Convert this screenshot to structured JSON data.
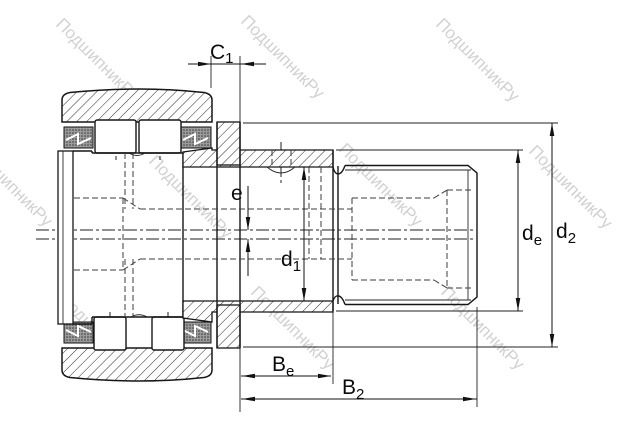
{
  "watermark": {
    "text": "ПодшипникРу"
  },
  "drawing": {
    "kind": "bearing-cross-section",
    "line_color": "#161616",
    "label_color": "#0b0b0f",
    "watermark_color": "#c9c9c9"
  },
  "labels": {
    "c1": {
      "base": "C",
      "sub": "1"
    },
    "e": {
      "base": "e",
      "sub": ""
    },
    "d1": {
      "base": "d",
      "sub": "1"
    },
    "de": {
      "base": "d",
      "sub": "e"
    },
    "d2": {
      "base": "d",
      "sub": "2"
    },
    "be": {
      "base": "B",
      "sub": "e"
    },
    "b2": {
      "base": "B",
      "sub": "2"
    }
  }
}
